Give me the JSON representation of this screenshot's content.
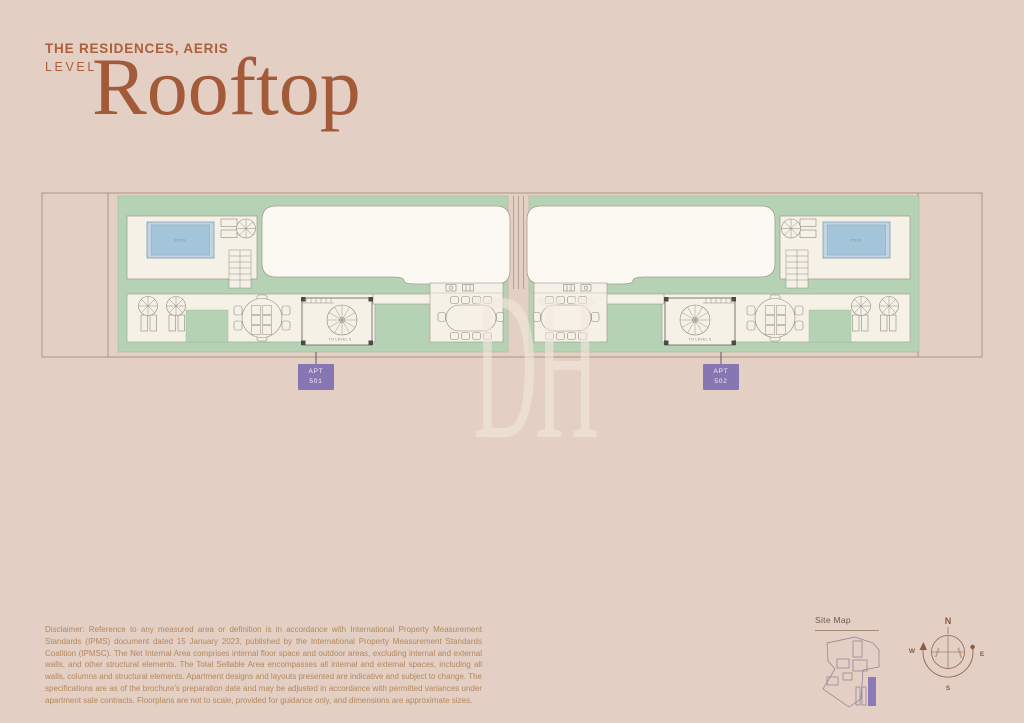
{
  "header": {
    "project": "THE RESIDENCES, AERIS",
    "level_label": "LEVEL",
    "level_name": "Rooftop"
  },
  "plan": {
    "pool_label": "POOL",
    "stair_label": "TO LEVEL 5",
    "badges": [
      {
        "tag": "APT",
        "number": "501"
      },
      {
        "tag": "APT",
        "number": "502"
      }
    ]
  },
  "watermark": {
    "text": "DH"
  },
  "disclaimer": {
    "text": "Disclaimer: Reference to any measured area or definition is in accordance with International Property Measurement Standards (IPMS) document dated 15 January 2023, published by the International Property Measurement Standards Coalition (IPMSC). The Net Internal Area comprises internal floor space and outdoor areas, excluding internal and external walls, and other structural elements. The Total Sellable Area encompasses all internal and external spaces, including all walls, columns and structural elements. Apartment designs and layouts presented are indicative and subject to change. The specifications are as of the brochure's preparation date and may be adjusted in accordance with permitted variances under apartment sale contracts. Floorplans are not to scale, provided for guidance only, and dimensions are approximate sizes."
  },
  "site_map": {
    "title": "Site Map"
  },
  "compass": {
    "north": "N",
    "south": "S",
    "east": "E",
    "west": "W",
    "sunset": "Sunset",
    "sunrise": "Sunrise"
  },
  "colors": {
    "background": "#e3cfc3",
    "title_terracotta": "#ad5f3c",
    "terrace_green": "#b6d2b5",
    "deck_cream": "#f6f1e7",
    "pool_blue": "#a3c4d9",
    "badge_purple": "#8677b3",
    "disclaimer_tan": "#b3885f"
  }
}
